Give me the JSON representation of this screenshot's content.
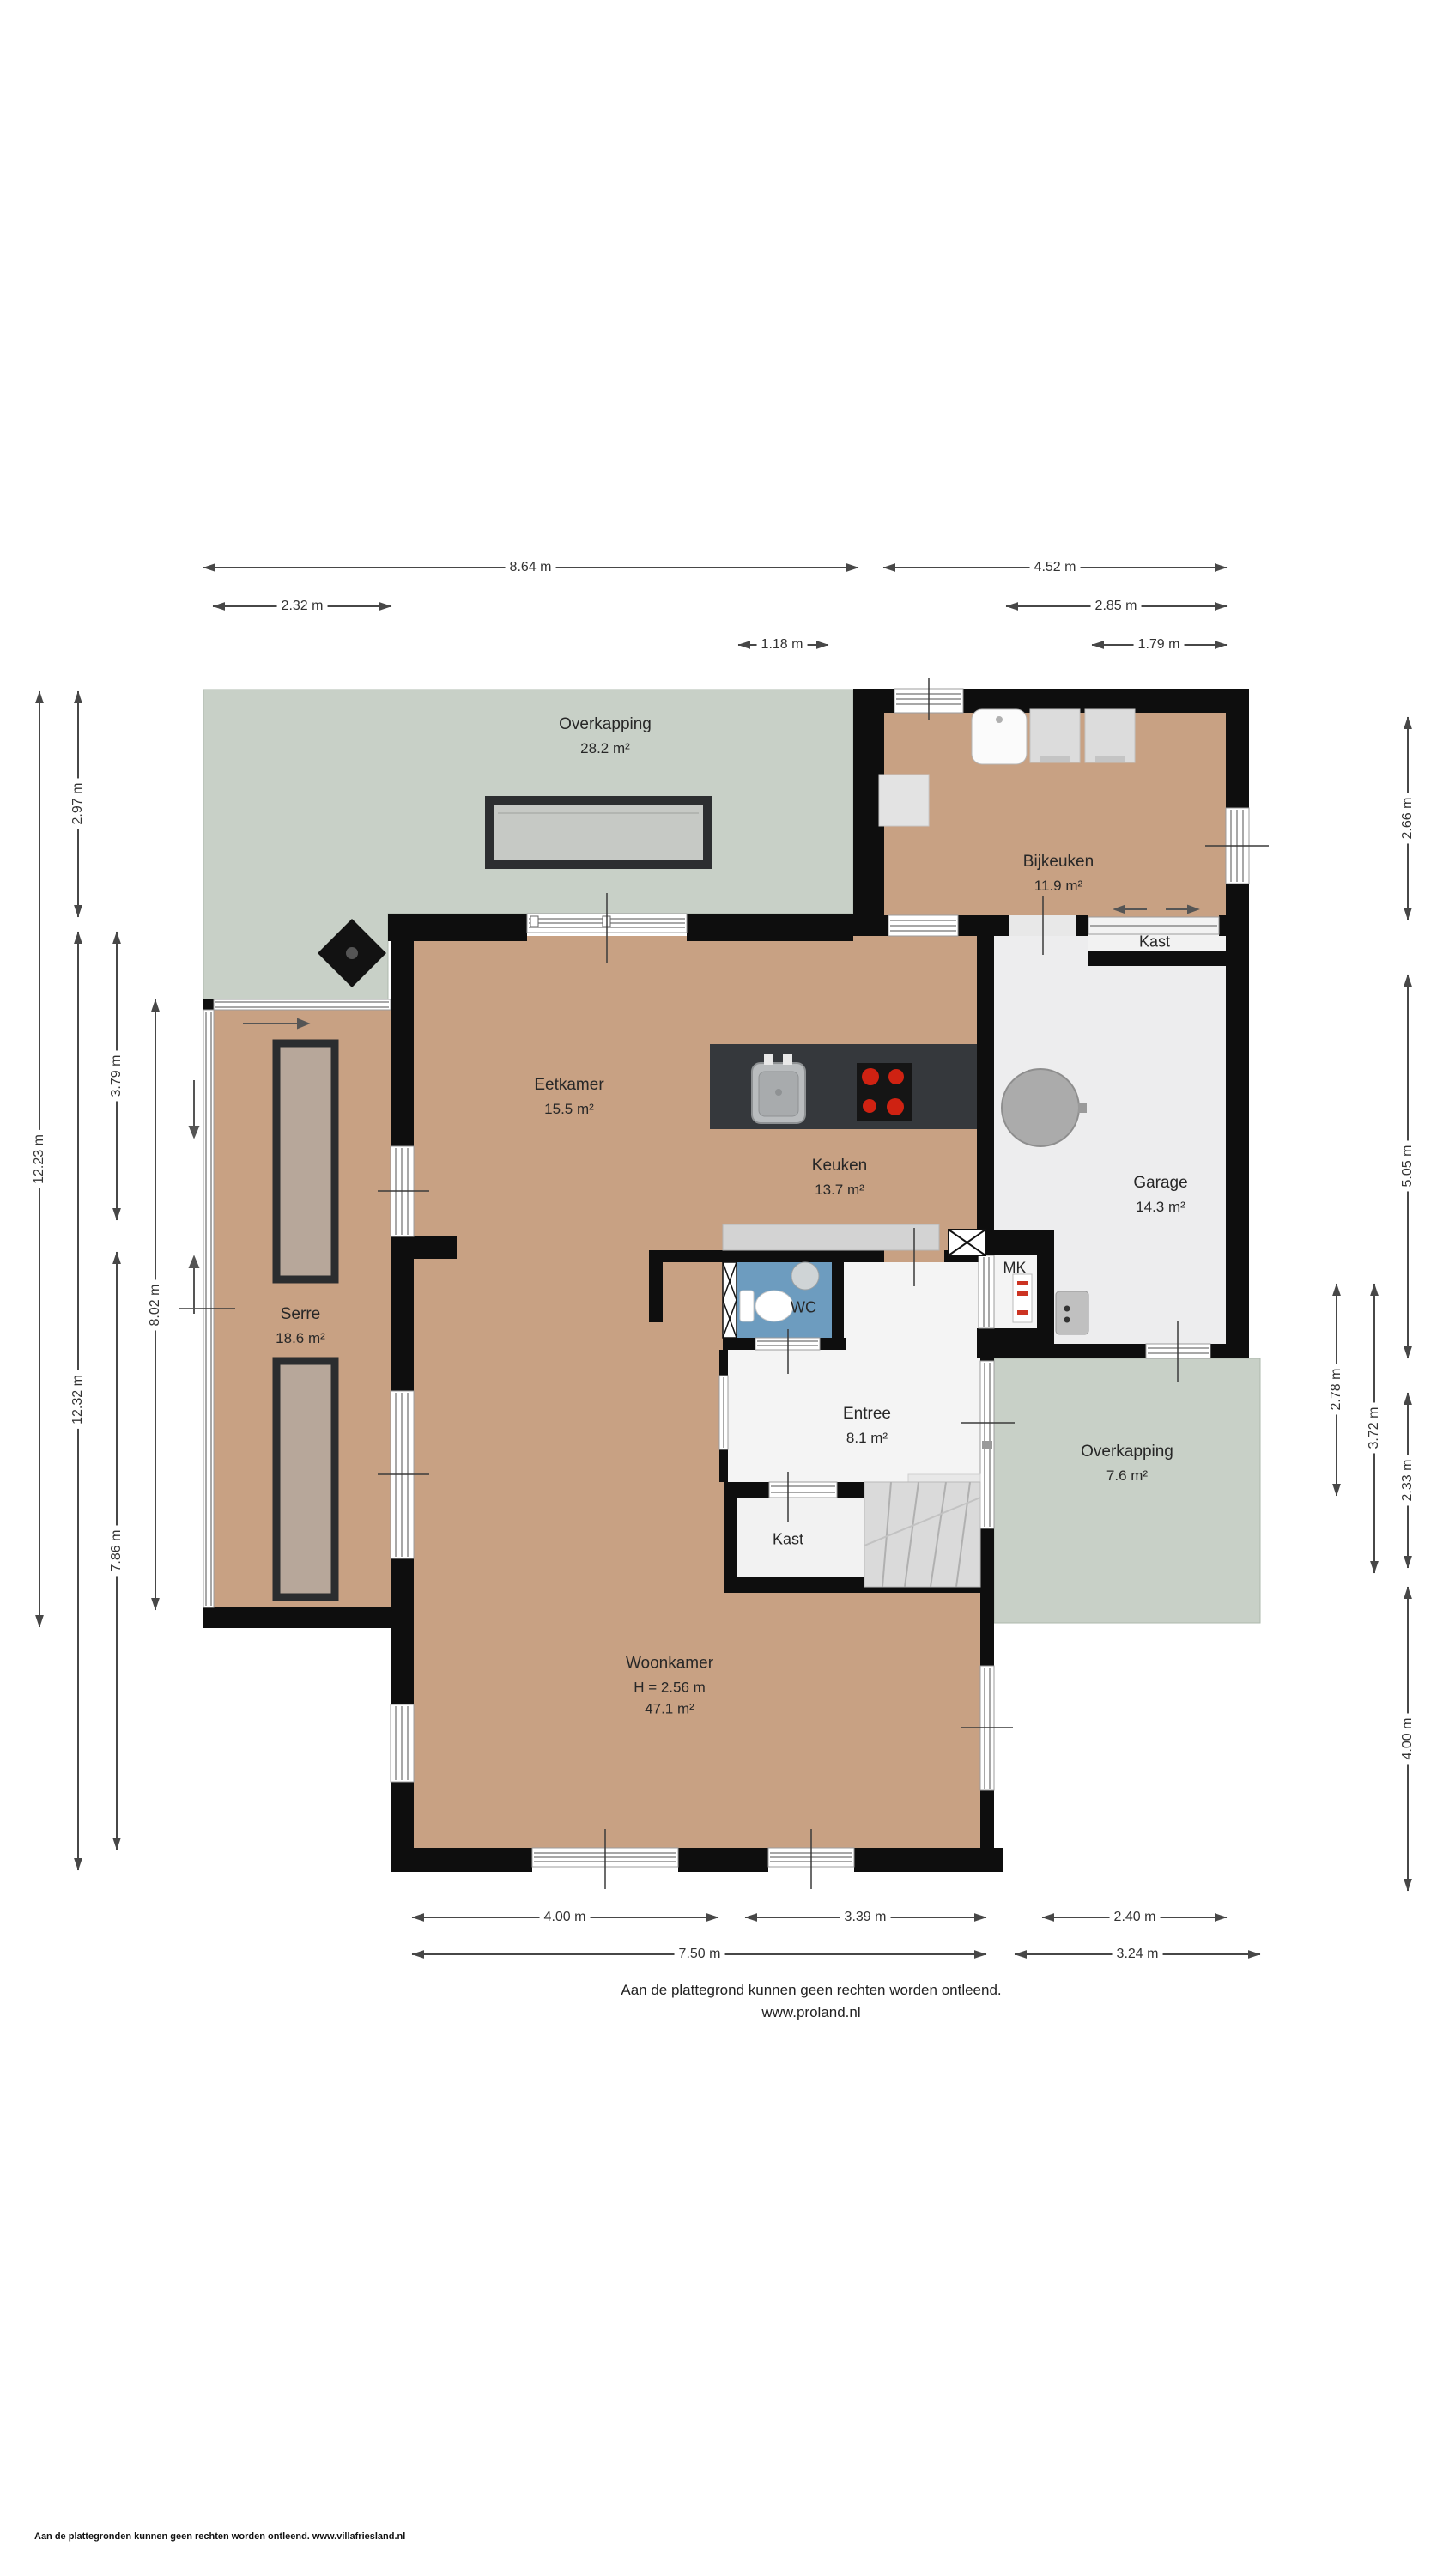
{
  "rooms": {
    "overkapping_top": {
      "name": "Overkapping",
      "area": "28.2 m²"
    },
    "bijkeuken": {
      "name": "Bijkeuken",
      "area": "11.9 m²"
    },
    "kast_garage": {
      "name": "Kast"
    },
    "eetkamer": {
      "name": "Eetkamer",
      "area": "15.5 m²"
    },
    "keuken": {
      "name": "Keuken",
      "area": "13.7 m²"
    },
    "garage": {
      "name": "Garage",
      "area": "14.3 m²"
    },
    "serre": {
      "name": "Serre",
      "area": "18.6 m²"
    },
    "wc": {
      "name": "WC"
    },
    "mk": {
      "name": "MK"
    },
    "entree": {
      "name": "Entree",
      "area": "8.1 m²"
    },
    "overkapping_right": {
      "name": "Overkapping",
      "area": "7.6 m²"
    },
    "kast_entree": {
      "name": "Kast"
    },
    "woonkamer": {
      "name": "Woonkamer",
      "ceiling_height": "H = 2.56 m",
      "area": "47.1 m²"
    }
  },
  "dimensions": {
    "top": [
      "8.64 m",
      "4.52 m",
      "2.32 m",
      "2.85 m",
      "1.18 m",
      "1.79 m"
    ],
    "left": [
      "12.23 m",
      "2.97 m",
      "12.32 m",
      "3.79 m",
      "7.86 m",
      "8.02 m"
    ],
    "right": [
      "2.66 m",
      "5.05 m",
      "2.33 m",
      "4.00 m",
      "2.78 m",
      "3.72 m"
    ],
    "bottom": [
      "4.00 m",
      "3.39 m",
      "2.40 m",
      "7.50 m",
      "3.24 m"
    ]
  },
  "footer": {
    "disclaimer": "Aan de plattegrond kunnen geen rechten worden ontleend.",
    "website": "www.proland.nl"
  },
  "page_footer": {
    "text": "Aan de plattegronden kunnen geen rechten worden ontleend. www.villafriesland.nl"
  },
  "symbols": {
    "kitchen_island": "sink-and-cooktop-icon",
    "cooktop": "four-burner-stove-icon",
    "wc": "toilet-and-washbasin-icon",
    "stairs": "winder-staircase-icon",
    "garage_object": "round-table-icon",
    "boiler": "boiler-unit-icon",
    "meter_cabinet": "meter-panel-icon",
    "chimney": "diamond-chimney-icon",
    "pergola": "skylight-panel-icon"
  },
  "colors": {
    "floor": "#c8a183",
    "outdoor": "#c8d0c7",
    "wall": "#0e0e0e",
    "wc_floor": "#6d9cbf",
    "garage_floor": "#ededee",
    "island_counter": "#35383c",
    "burner_red": "#cf2212"
  }
}
